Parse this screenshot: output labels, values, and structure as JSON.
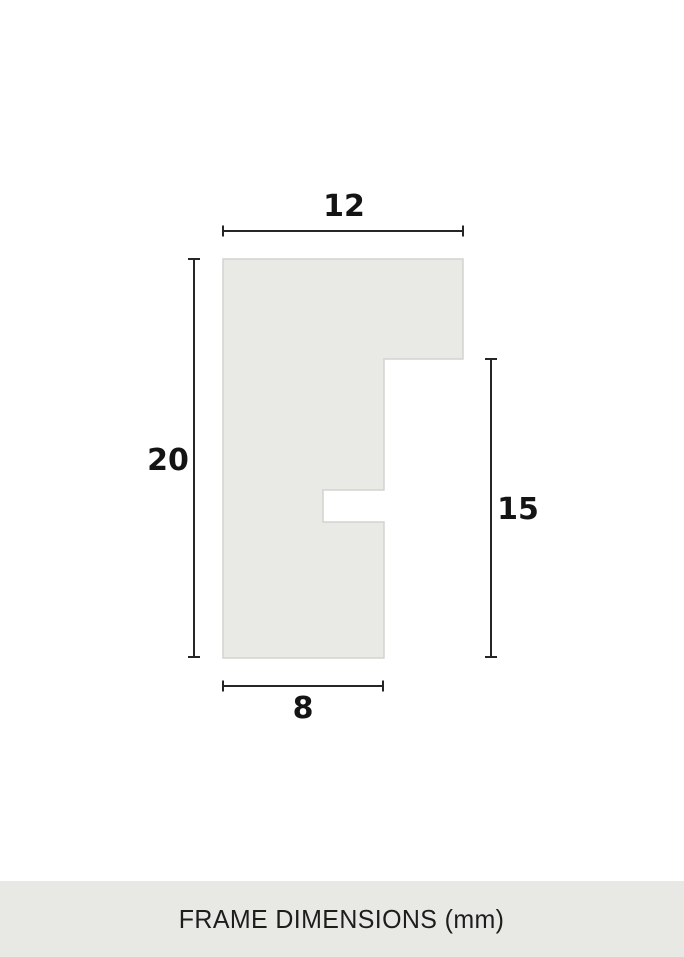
{
  "diagram": {
    "title": "frame-profile-cross-section",
    "unit": "mm",
    "dimensions": {
      "top_width": {
        "label": "12"
      },
      "left_height": {
        "label": "20"
      },
      "right_height": {
        "label": "15"
      },
      "bottom_width": {
        "label": "8"
      }
    },
    "colors": {
      "profile_fill": "#e9eae6",
      "profile_stroke": "#d3d3cf",
      "dimension_line": "#262626",
      "label_text": "#141414",
      "footer_background": "#e8e9e5",
      "page_background": "#ffffff"
    }
  },
  "footer": {
    "title": "FRAME DIMENSIONS (mm)"
  }
}
